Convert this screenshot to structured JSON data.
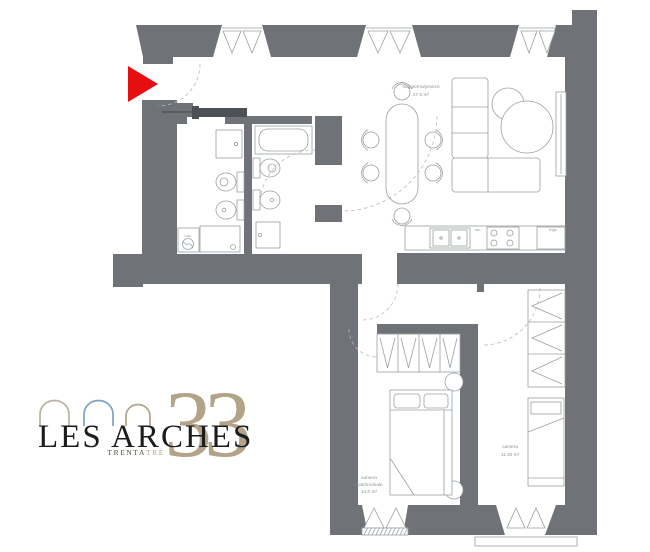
{
  "logo": {
    "brand": "LES ARCHES",
    "number": "33",
    "subtitle_dark": "TRENTA",
    "subtitle_accent": "TRÉ"
  },
  "rooms": {
    "living": {
      "name": "soggiorno/pranzo",
      "area": "27.0 m²"
    },
    "master": {
      "name1": "camera",
      "name2": "matrimoniale",
      "area": "14.0 m²"
    },
    "second": {
      "name": "camera",
      "area": "11.30 m²"
    }
  },
  "appliances": {
    "washer": "Lav.",
    "dishwasher": "lav.",
    "fridge": "frigo"
  },
  "colors": {
    "wall": "#6f7277",
    "wall_dark": "#4d5055",
    "line": "#9aa0a3",
    "line_light": "#b7babc",
    "arrow": "#e70e12",
    "label": "#8f9294",
    "logo_text": "#1b1c1e",
    "logo_subdark": "#55503f",
    "logo_gold": "#b3a489",
    "logo_blue": "#7ba3c4",
    "logo_gray": "#bab3a5"
  }
}
